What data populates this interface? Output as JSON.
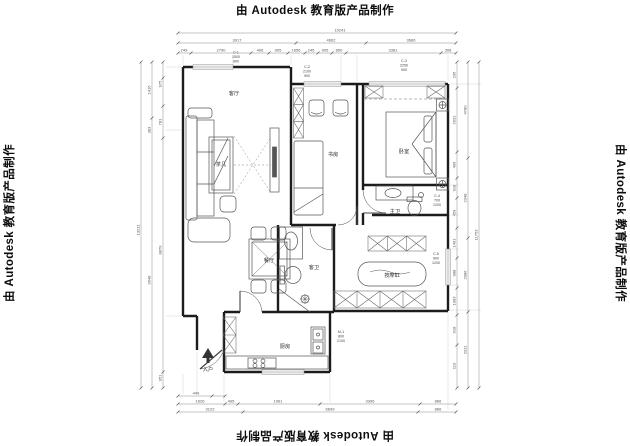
{
  "watermark": {
    "text": "由 Autodesk 教育版产品制作"
  },
  "rooms": {
    "living": "客厅",
    "coffee_table": "茶几",
    "study": "书房",
    "bedroom": "卧室",
    "master_bath": "主卫",
    "guest_bath": "客卫",
    "dining": "餐厅",
    "kitchen": "厨房",
    "bathtub": "按摩缸",
    "entry": "入户"
  },
  "tags": {
    "c1": [
      "C-1",
      "1500",
      "900"
    ],
    "c2": [
      "C-2",
      "2100",
      "900"
    ],
    "c3": [
      "C-3",
      "2250",
      "900"
    ],
    "c4": [
      "C-4",
      "700",
      "1200"
    ],
    "c5": [
      "C-5",
      "900",
      "1200"
    ],
    "m1": [
      "M-1",
      "800",
      "2100"
    ]
  },
  "dims": {
    "top": {
      "total": "10241",
      "tier2": [
        "3917",
        "4662",
        "3666"
      ],
      "tier3": [
        "249",
        "2790",
        "406",
        "905",
        "1656",
        "245",
        "905",
        "850",
        "3381",
        "308"
      ]
    },
    "left": {
      "outer": "13211",
      "mid": [
        "1416",
        "383",
        "9648"
      ],
      "inner": [
        "975",
        "781",
        "8879",
        "951"
      ]
    },
    "right": {
      "outer": "11753",
      "mid": [
        "4780",
        "2348",
        "2986",
        "2311"
      ],
      "inner": [
        "206",
        "2931",
        "499",
        "918",
        "459",
        "1491",
        "988",
        "1083",
        "918",
        "110"
      ]
    },
    "bottom": {
      "tier1": [
        "449"
      ],
      "tier2": [
        "1626",
        "495",
        "1961",
        "3396",
        "866"
      ],
      "tier3": [
        "3122",
        "6699",
        "866"
      ]
    }
  }
}
